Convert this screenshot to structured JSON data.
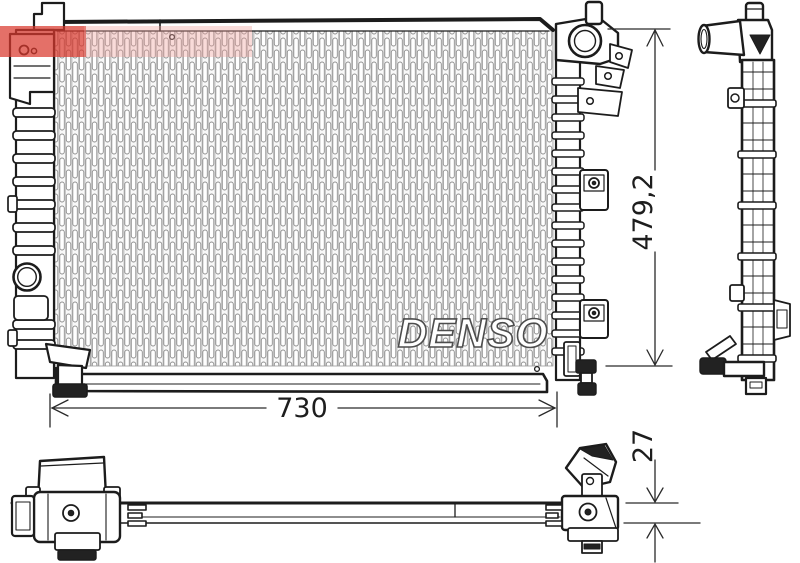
{
  "drawing": {
    "type": "radiator-technical-drawing",
    "watermark_brand": "DENSO",
    "stamp": {
      "primary_color": "#d9392e",
      "secondary_color": "#efa09a"
    },
    "dimensions": {
      "width_mm": "730",
      "height_mm": "479,2",
      "depth_mm": "27"
    },
    "line_color": "#1c1c1c"
  }
}
